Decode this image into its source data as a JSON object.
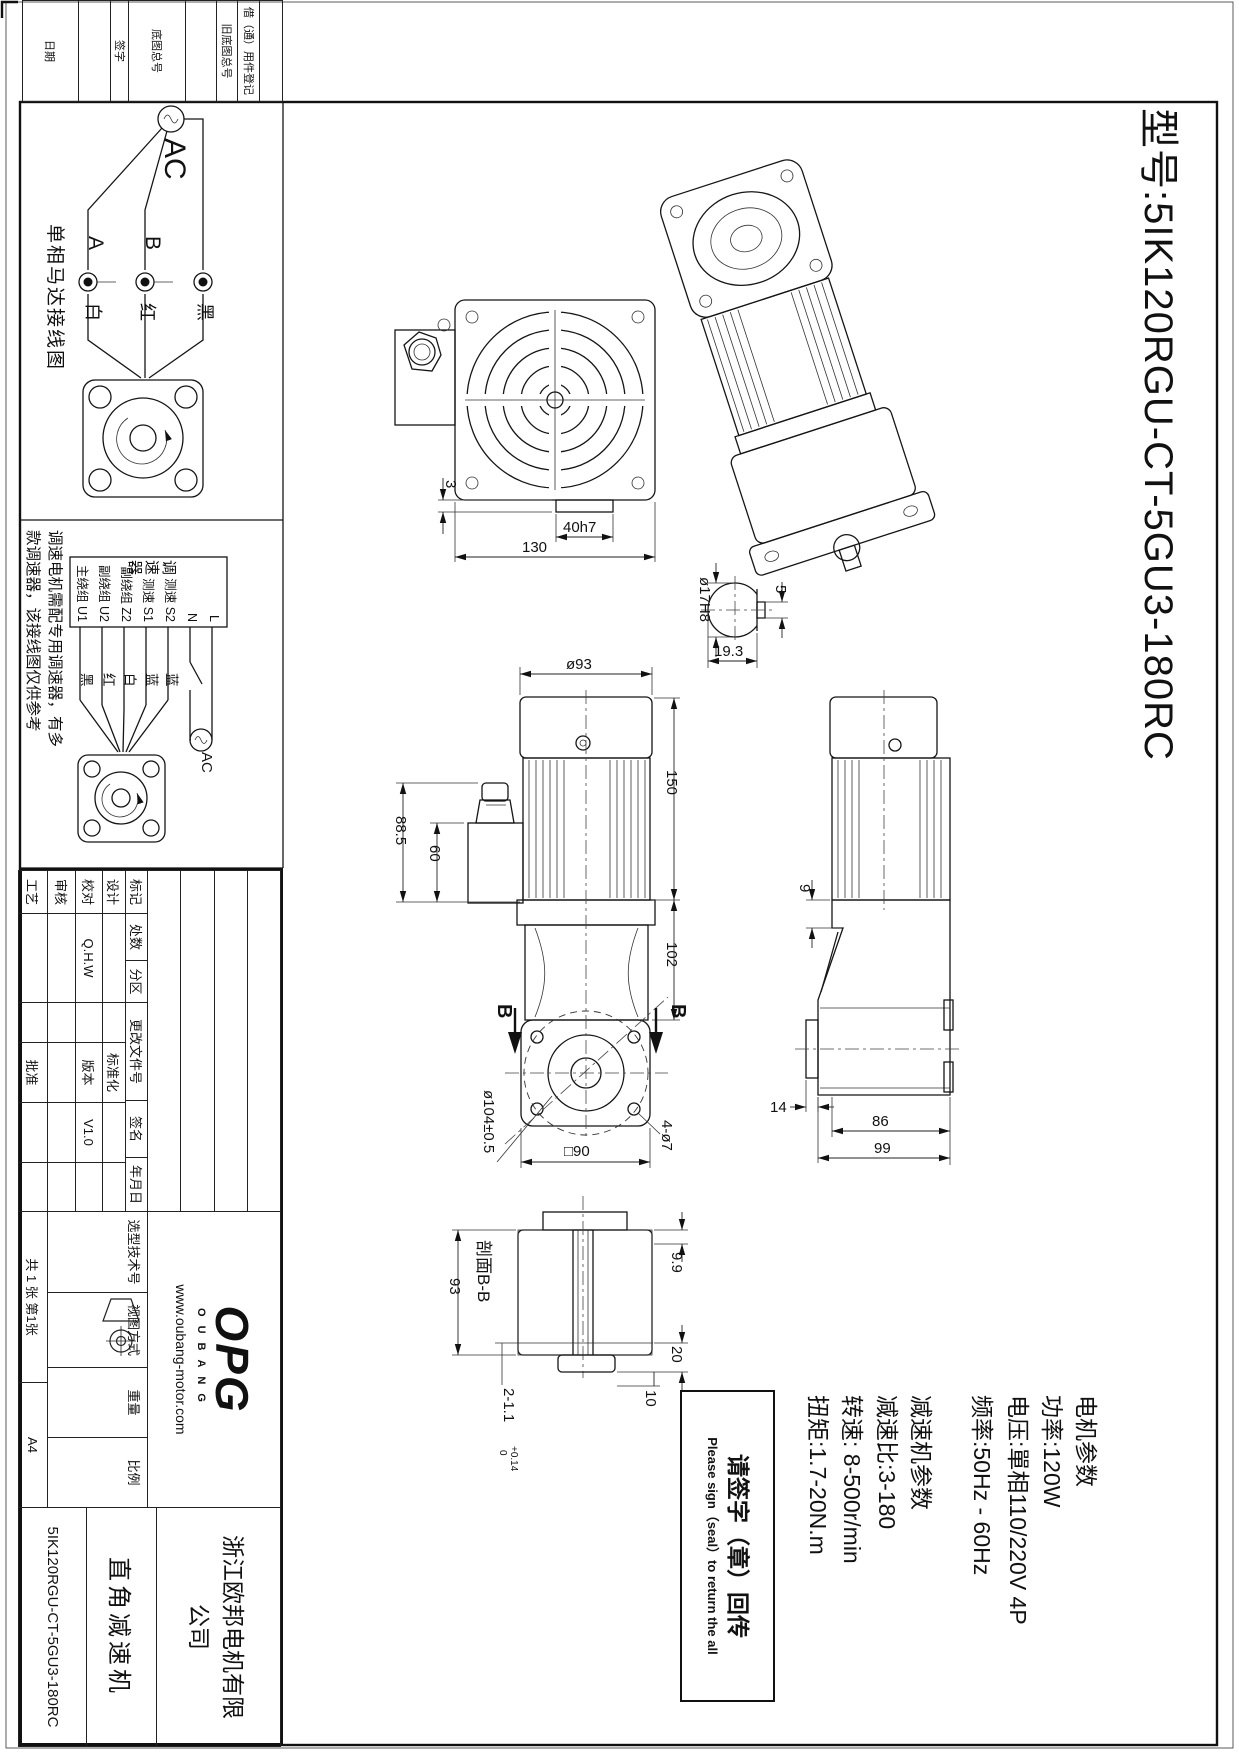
{
  "sheet": {
    "model_title": "型号:5IK120RGU-CT-5GU3-180RC",
    "margin_fields": [
      "借（通）用件登记",
      "旧底图总号",
      "底图总号",
      "签字",
      "日期"
    ]
  },
  "wiring_single_phase": {
    "title": "单相马达接线图",
    "source_label": "AC",
    "terminal_a": "A",
    "terminal_b": "B",
    "wire_white": "白",
    "wire_red": "红",
    "wire_black": "黑"
  },
  "wiring_controller": {
    "controller_name": "调速器",
    "terminals": [
      "主绕组 U1",
      "副绕组 U2",
      "副绕组 Z2",
      "测速 S1",
      "测速 S2",
      "N",
      "L"
    ],
    "wire_colors": [
      "黑",
      "红",
      "白",
      "蓝",
      "蓝"
    ],
    "source_label": "AC",
    "note_line1": "调速电机需配专用调速器，有多",
    "note_line2": "款调速器，该接线图仅供参考"
  },
  "views": {
    "rear": {
      "dim_shaft": "40h7",
      "dim_step": "3",
      "dim_width": "130"
    },
    "shaft_detail": {
      "dim_dia": "ø17H8",
      "dim_across": "19.3",
      "dim_flat": "5"
    },
    "front": {
      "dim_dia": "ø93",
      "dim_box_h": "88.5",
      "dim_box_w": "60",
      "dim_motor": "150",
      "dim_gear": "102",
      "dim_bolt_circle": "ø104±0.5",
      "dim_square": "□90",
      "dim_holes": "4-ø7",
      "section_mark": "B"
    },
    "side": {
      "dim_step": "9",
      "dim_shaft_len": "14",
      "dim_body": "86",
      "dim_total": "99"
    },
    "section_bb": {
      "label": "剖面B-B",
      "dim_h": "93",
      "dim_top": "9.9",
      "dim_hub": "20",
      "dim_bottom": "10",
      "dim_key": "2-1.1",
      "tol_hi": "+0.14",
      "tol_lo": "0"
    }
  },
  "parameters": {
    "motor_header": "电机参数",
    "power": "功率:120W",
    "voltage": "电压:單相110/220V 4P",
    "frequency": "频率:50Hz - 60Hz",
    "gear_header": "减速机参数",
    "ratio": "减速比:3-180",
    "speed": "转速: 8-500r/min",
    "torque": "扭矩:1.7-20N.m"
  },
  "sign_box": {
    "line1": "请签字（章）回传",
    "line2": "Please sign（seal）to return the all"
  },
  "title_block": {
    "rev_headers": [
      "标记",
      "处数",
      "分区",
      "更改文件号",
      "签名",
      "年月日"
    ],
    "row_design": "设计",
    "row_check": "校对",
    "row_review": "审核",
    "row_process": "工艺",
    "standardization": "标准化",
    "version_label": "版本",
    "version_value": "V1.0",
    "approve": "批准",
    "designer": "Q.H.W",
    "selection_no": "选型技术号",
    "view_method": "视图方式",
    "weight": "重量",
    "scale": "比例",
    "sheet_count": "共 1 张 第1张",
    "paper_size": "A4",
    "logo_main": "OPG",
    "logo_sub": "OUBANG",
    "website": "www.oubang-motor.com",
    "company": "浙江欧邦电机有限公司",
    "product": "直角减速机",
    "drawing_no": "5IK120RGU-CT-5GU3-180RC"
  }
}
